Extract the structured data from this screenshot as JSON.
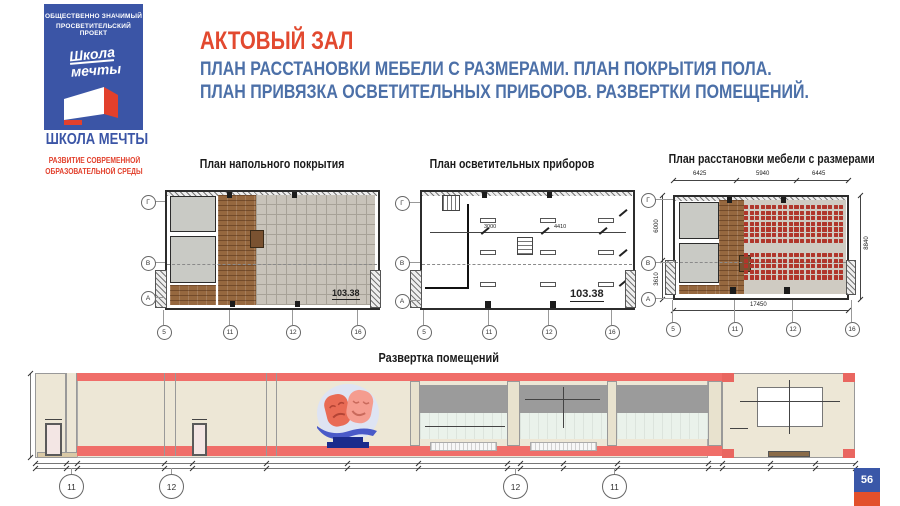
{
  "page": {
    "number": "56"
  },
  "logo": {
    "project_line1": "ОБЩЕСТВЕННО ЗНАЧИМЫЙ",
    "project_line2": "ПРОСВЕТИТЕЛЬСКИЙ ПРОЕКТ",
    "script_line1": "Школа",
    "script_line2": "мечты",
    "brand": "ШКОЛА МЕЧТЫ",
    "tagline_line1": "РАЗВИТИЕ СОВРЕМЕННОЙ",
    "tagline_line2": "ОБРАЗОВАТЕЛЬНОЙ СРЕДЫ"
  },
  "header": {
    "title": "АКТОВЫЙ ЗАЛ",
    "subtitle_line1": "ПЛАН РАССТАНОВКИ МЕБЕЛИ С РАЗМЕРАМИ. ПЛАН ПОКРЫТИЯ ПОЛА.",
    "subtitle_line2": "ПЛАН ПРИВЯЗКА ОСВЕТИТЕЛЬНЫХ ПРИБОРОВ. РАЗВЕРТКИ ПОМЕЩЕНИЙ."
  },
  "plans": {
    "floor": {
      "title": "План напольного покрытия",
      "area_label": "103.38",
      "axis_rows": [
        "Г",
        "В",
        "А"
      ],
      "axis_cols": [
        "5",
        "11",
        "12",
        "16"
      ]
    },
    "lighting": {
      "title": "План осветительных приборов",
      "area_label": "103.38",
      "dim_a": "3000",
      "dim_b": "4410",
      "axis_rows": [
        "Г",
        "В",
        "А"
      ],
      "axis_cols": [
        "5",
        "11",
        "12",
        "16"
      ],
      "fixtures": {
        "rows": 3,
        "cols": 3
      }
    },
    "furniture": {
      "title": "План расстановки мебели с размерами",
      "dims_top": [
        "6425",
        "5940",
        "6445"
      ],
      "dim_left_top": "6000",
      "dim_left_bottom": "3610",
      "dim_right": "8840",
      "dim_bottom": "17450",
      "axis_rows": [
        "Г",
        "В",
        "А"
      ],
      "axis_cols": [
        "5",
        "11",
        "12",
        "16"
      ],
      "seats": {
        "rows_upper": 7,
        "rows_lower": 5,
        "cols": 18
      }
    }
  },
  "elevation": {
    "title": "Развертка помещений",
    "axis_circles": [
      "11",
      "12",
      "12",
      "11"
    ]
  },
  "colors": {
    "accent_red": "#E2492F",
    "title_blue": "#4C70A8",
    "logo_blue": "#3B55A6",
    "stripe_red": "#F06E69",
    "seat_red": "#B0362B"
  }
}
